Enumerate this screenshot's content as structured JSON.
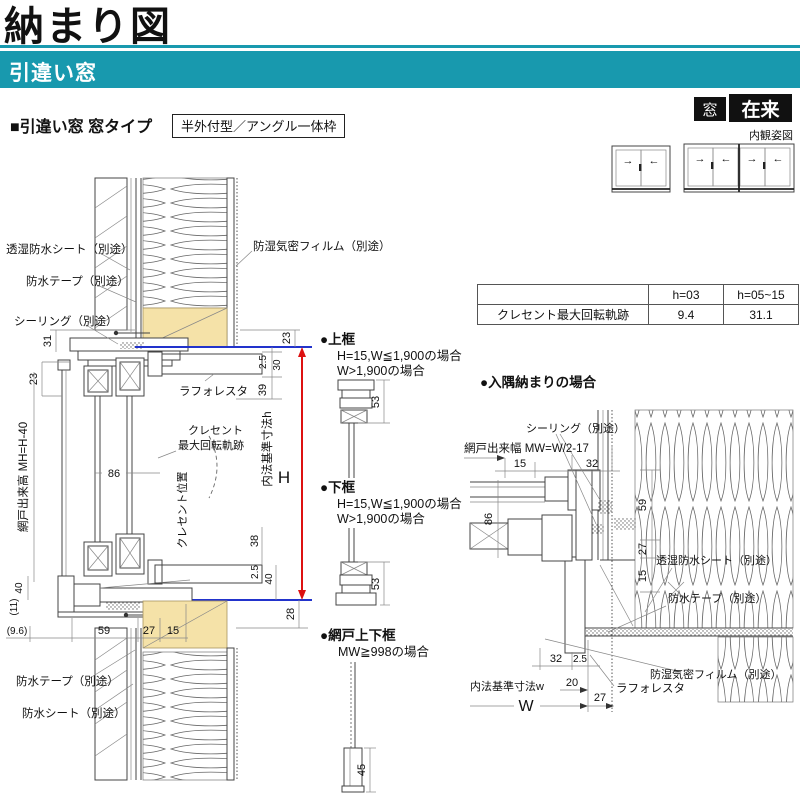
{
  "header": {
    "title": "納まり図",
    "banner": "引違い窓",
    "section_heading": "■引違い窓 窓タイプ",
    "section_tag": "半外付型／アングル一体枠",
    "badge_mado": "窓",
    "badge_zairai": "在来",
    "naikan_label": "内観姿図"
  },
  "colors": {
    "teal": "#1899ae",
    "blue_line": "#2233cc",
    "red_line": "#dd1111",
    "wood": "#f5e2a8"
  },
  "crescent_table": {
    "headers": [
      "",
      "h=03",
      "h=05~15"
    ],
    "row_label": "クレセント最大回転軌跡",
    "values": [
      "9.4",
      "31.1"
    ]
  },
  "naikan_windows": [
    {
      "panels": [
        "→",
        "←"
      ]
    },
    {
      "panels": [
        "→",
        "←",
        "→",
        "←"
      ]
    }
  ],
  "main_section": {
    "labels": {
      "toshitsu_sheet": "透湿防水シート（別途）",
      "tape_top": "防水テープ（別途）",
      "sealing": "シーリング（別途）",
      "film": "防湿気密フィルム（別途）",
      "rafforesta": "ラフォレスタ",
      "crescent1": "クレセント",
      "crescent2": "最大回転軌跡",
      "crescent_pos": "クレセント位置",
      "amido_h": "網戸出来高 MH=H-40",
      "uchinori_h": "内法基準寸法h",
      "H": "H",
      "tape_btm": "防水テープ（別途）",
      "sheet_btm": "防水シート（別途）"
    },
    "dims": {
      "d31": "31",
      "d23_left": "23",
      "d23_right": "23",
      "d25_top": "2.5",
      "d30": "30",
      "d39": "39",
      "d86": "86",
      "d38": "38",
      "d25_btm": "2.5",
      "d40_right": "40",
      "d28": "28",
      "d40_left": "40",
      "d11": "(11)",
      "d96": "(9.6)",
      "d59": "59",
      "d27": "27",
      "d15": "15"
    }
  },
  "details": {
    "top_rail": {
      "title": "●上框",
      "cond1": "H=15,W≦1,900の場合",
      "cond2": "W>1,900の場合",
      "dim53": "53"
    },
    "bottom_rail": {
      "title": "●下框",
      "cond1": "H=15,W≦1,900の場合",
      "cond2": "W>1,900の場合",
      "dim53": "53"
    },
    "screen_rail": {
      "title": "●網戸上下框",
      "cond": "MW≧998の場合",
      "dim45": "45"
    }
  },
  "irisumi": {
    "title": "●入隅納まりの場合",
    "labels": {
      "sealing": "シーリング（別途）",
      "amido_w": "網戸出来幅 MW=W/2-17",
      "toshitsu_sheet": "透湿防水シート（別途）",
      "tape": "防水テープ（別途）",
      "film": "防湿気密フィルム（別途）",
      "rafforesta": "ラフォレスタ",
      "uchinori_w": "内法基準寸法w",
      "W": "W"
    },
    "dims": {
      "d15_top": "15",
      "d32_top": "32",
      "d86": "86",
      "d59": "59",
      "d27_right": "27",
      "d15_right": "15",
      "d32_btm": "32",
      "d25": "2.5",
      "d20": "20",
      "d27_btm": "27"
    }
  }
}
